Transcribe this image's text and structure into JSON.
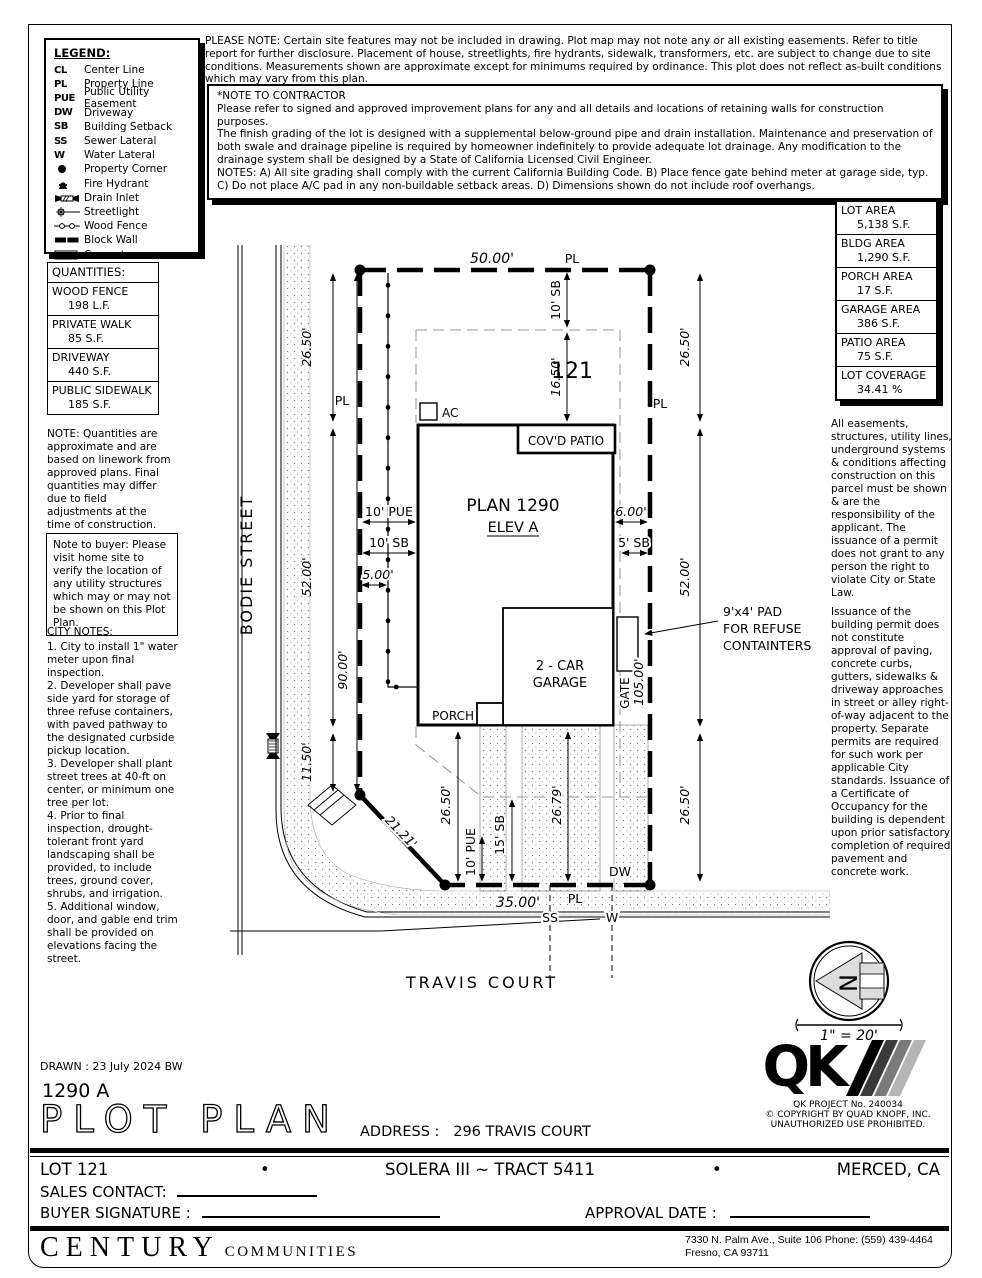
{
  "legend": {
    "title": "LEGEND:",
    "items": [
      {
        "abbr": "CL",
        "label": "Center Line"
      },
      {
        "abbr": "PL",
        "label": "Property Line"
      },
      {
        "abbr": "PUE",
        "label": "Public Utility Easement"
      },
      {
        "abbr": "DW",
        "label": "Driveway"
      },
      {
        "abbr": "SB",
        "label": "Building Setback"
      },
      {
        "abbr": "SS",
        "label": "Sewer Lateral"
      },
      {
        "abbr": "W",
        "label": "Water Lateral"
      },
      {
        "abbr": "",
        "label": "Property Corner"
      },
      {
        "abbr": "",
        "label": "Fire Hydrant"
      },
      {
        "abbr": "",
        "label": "Drain Inlet"
      },
      {
        "abbr": "",
        "label": "Streetlight"
      },
      {
        "abbr": "",
        "label": "Wood Fence"
      },
      {
        "abbr": "",
        "label": "Block Wall"
      },
      {
        "abbr": "",
        "label": "Concrete"
      }
    ]
  },
  "top_note": "PLEASE NOTE:  Certain site features may not be included in drawing.  Plot map may not note any or all existing easements. Refer to title report for further disclosure.  Placement of house, streetlights, fire hydrants, sidewalk, transformers, etc. are subject to change due to site conditions.  Measurements shown are approximate except for minimums required by ordinance.  This plot does not reflect as-built conditions which may vary from this plan.",
  "contractor": {
    "title": "*NOTE TO CONTRACTOR",
    "p1": "Please refer to signed and approved improvement plans for any and all details and locations of retaining walls for construction purposes.",
    "p2": "The finish grading of the lot is designed with a supplemental below-ground pipe and drain installation.  Maintenance and preservation of both swale and drainage pipeline is required by homeowner indefinitely to provide adequate lot drainage.  Any modification to the drainage system shall be designed by a State of California Licensed Civil Engineer.",
    "p3": "NOTES:  A) All site grading shall comply with the current California Building Code.  B) Place fence gate behind meter at garage side, typ.  C) Do not place A/C pad in any non-buildable setback areas.  D) Dimensions shown do not include roof overhangs."
  },
  "quantities": {
    "title": "QUANTITIES:",
    "rows": [
      {
        "name": "WOOD FENCE",
        "value": "198 L.F."
      },
      {
        "name": "PRIVATE WALK",
        "value": "85 S.F."
      },
      {
        "name": "DRIVEWAY",
        "value": "440 S.F."
      },
      {
        "name": "PUBLIC SIDEWALK",
        "value": "185 S.F."
      }
    ],
    "note": "NOTE: Quantities are approximate and are based on linework from approved plans.  Final quantities may differ due to field adjustments at the time of construction."
  },
  "buyer_note": "Note to buyer: Please visit home site to verify the location of any utility structures which may or may not be shown on this Plot Plan.",
  "city_notes": {
    "title": "CITY NOTES:",
    "items": [
      "1. City to install 1\" water meter upon final inspection.",
      "2. Developer shall pave side yard for storage of three refuse containers, with paved pathway to the designated curbside pickup location.",
      "3. Developer shall plant street trees at 40-ft on center, or minimum one tree per lot.",
      "4. Prior to final inspection, drought-tolerant front yard landscaping shall be provided, to include trees, ground cover, shrubs, and irrigation.",
      "5. Additional window, door, and gable end trim shall be provided on elevations facing the street."
    ]
  },
  "areas": {
    "rows": [
      {
        "name": "LOT AREA",
        "value": "5,138 S.F."
      },
      {
        "name": "BLDG AREA",
        "value": "1,290 S.F."
      },
      {
        "name": "PORCH AREA",
        "value": "17 S.F."
      },
      {
        "name": "GARAGE AREA",
        "value": "386 S.F."
      },
      {
        "name": "PATIO AREA",
        "value": "75 S.F."
      },
      {
        "name": "LOT COVERAGE",
        "value": "34.41 %"
      }
    ]
  },
  "easements": {
    "p1": "All easements, structures, utility lines, underground systems & conditions affecting construction on this parcel must be shown & are the responsibility of the applicant. The issuance of a permit does not grant to any person the right to violate City or State Law.",
    "p2": "Issuance of the building permit does not constitute approval of paving, concrete curbs, gutters, sidewalks & driveway approaches in street or alley right-of-way adjacent to the property. Separate permits are required for such work per applicable City standards. Issuance of a Certificate of Occupancy for the building is dependent upon prior satisfactory completion of required pavement and concrete work."
  },
  "plan": {
    "labels": {
      "lot_number": "121",
      "plan_name": "PLAN 1290",
      "elevation": "ELEV A",
      "patio": "COV'D PATIO",
      "ac": "AC",
      "garage1": "2 - CAR",
      "garage2": "GARAGE",
      "porch": "PORCH",
      "gate": "GATE",
      "pad1": "9'x4' PAD",
      "pad2": "FOR REFUSE",
      "pad3": "CONTAINTERS",
      "street_left": "BODIE STREET",
      "street_bottom": "TRAVIS COURT",
      "pl": "PL",
      "dw": "DW",
      "ss": "SS",
      "w": "W"
    },
    "dims": {
      "top_width": "50.00'",
      "sb_front": "10' SB",
      "front_inner": "16.50'",
      "left_top": "26.50'",
      "left_mid": "52.00'",
      "left_low": "11.50'",
      "left_total": "90.00'",
      "right_top": "26.50'",
      "right_mid": "52.00'",
      "right_low": "26.50'",
      "right_total": "105.00'",
      "pue_side": "10' PUE",
      "sb_side": "10' SB",
      "gap_left": "5.00'",
      "gap_right": "6.00'",
      "sb_right": "5' SB",
      "diag": "21.21'",
      "rear_left": "26.50'",
      "pue_front": "10' PUE",
      "sb_front2": "15' SB",
      "drive_len": "26.79'",
      "bottom_width": "35.00'"
    }
  },
  "north": {
    "letter": "N",
    "scale": "1\" = 20'"
  },
  "titleblock": {
    "drawn": "DRAWN :  23 July 2024  BW",
    "plan_code": "1290  A",
    "title": "PLOT PLAN",
    "address_label": "ADDRESS :",
    "address_value": "296 TRAVIS COURT",
    "qk": "QK",
    "qk_project": "QK PROJECT No. 240034",
    "qk_copyright": "©  COPYRIGHT BY QUAD KNOPF, INC.",
    "qk_unauthorized": "UNAUTHORIZED USE PROHIBITED.",
    "lot": "LOT 121",
    "bullet": "•",
    "tract": "SOLERA III ~ TRACT 5411",
    "city": "MERCED, CA",
    "sales_contact_label": "SALES CONTACT:",
    "buyer_signature_label": "BUYER SIGNATURE :",
    "approval_date_label": "APPROVAL DATE :",
    "company_name": "CENTURY",
    "company_suffix": "COMMUNITIES",
    "office_line1": "7330 N. Palm Ave., Suite 106    Phone:  (559) 439-4464",
    "office_line2": "Fresno, CA  93711"
  }
}
